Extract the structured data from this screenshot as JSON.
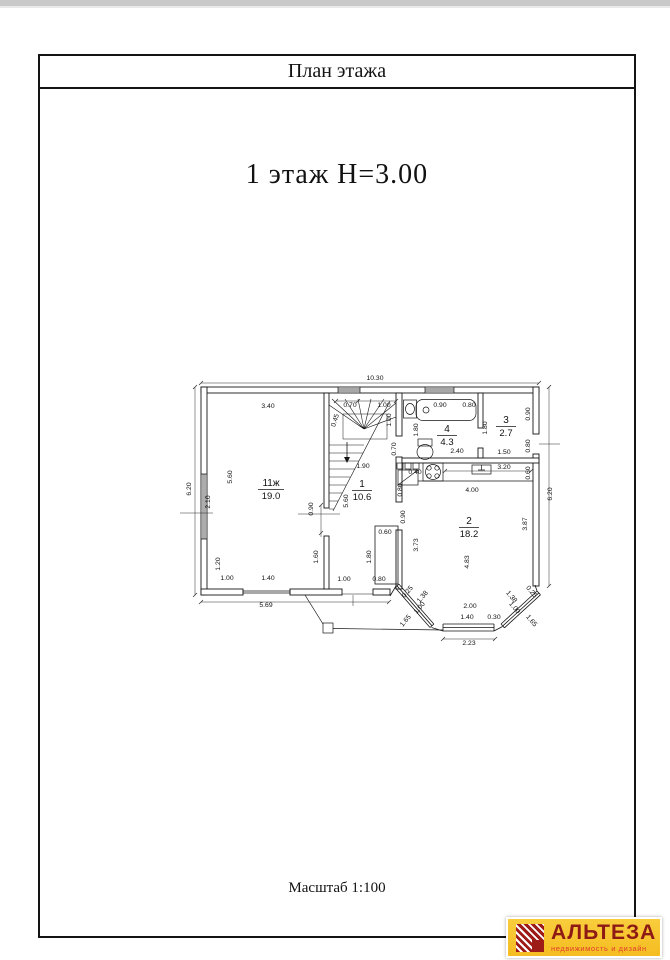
{
  "page": {
    "title": "План этажа",
    "heading": "1 этаж  Н=3.00",
    "scale_note": "Масштаб 1:100"
  },
  "logo": {
    "name": "АЛЬТЕЗА",
    "tagline": "недвижимость и дизайн",
    "bg_color": "#f6c230",
    "text_color": "#8e1a16",
    "tagline_color": "#e03c2d"
  },
  "plan": {
    "floor_height": "3.00",
    "rooms": [
      {
        "number": "11ж",
        "area": "19.0",
        "x": 231,
        "y": 430
      },
      {
        "number": "1",
        "area": "10.6",
        "x": 322,
        "y": 431
      },
      {
        "number": "2",
        "area": "18.2",
        "x": 429,
        "y": 468
      },
      {
        "number": "3",
        "area": "2.7",
        "x": 466,
        "y": 367
      },
      {
        "number": "4",
        "area": "4.3",
        "x": 407,
        "y": 376
      }
    ],
    "dimensions": [
      {
        "t": "10.30",
        "x": 335,
        "y": 324
      },
      {
        "t": "3.40",
        "x": 228,
        "y": 352
      },
      {
        "t": "0.70",
        "x": 310,
        "y": 351
      },
      {
        "t": "1.00",
        "x": 344,
        "y": 351
      },
      {
        "t": "0.45",
        "x": 297,
        "y": 365,
        "r": -72
      },
      {
        "t": "1.00",
        "x": 351,
        "y": 364,
        "r": -90
      },
      {
        "t": "0.90",
        "x": 400,
        "y": 351
      },
      {
        "t": "0.80",
        "x": 429,
        "y": 351
      },
      {
        "t": "1.80",
        "x": 378,
        "y": 374,
        "r": -90
      },
      {
        "t": "0.70",
        "x": 356,
        "y": 393,
        "r": -90
      },
      {
        "t": "2.40",
        "x": 417,
        "y": 397
      },
      {
        "t": "1.80",
        "x": 447,
        "y": 372,
        "r": -90
      },
      {
        "t": "0.90",
        "x": 490,
        "y": 358,
        "r": -90
      },
      {
        "t": "0.80",
        "x": 490,
        "y": 390,
        "r": -90
      },
      {
        "t": "1.50",
        "x": 464,
        "y": 398
      },
      {
        "t": "1.90",
        "x": 323,
        "y": 412
      },
      {
        "t": "5.60",
        "x": 308,
        "y": 445,
        "r": -90
      },
      {
        "t": "0.90",
        "x": 273,
        "y": 453,
        "r": -90
      },
      {
        "t": "1.60",
        "x": 278,
        "y": 501,
        "r": -90
      },
      {
        "t": "1.80",
        "x": 331,
        "y": 501,
        "r": -90
      },
      {
        "t": "0.60",
        "x": 345,
        "y": 478
      },
      {
        "t": "1.00",
        "x": 304,
        "y": 525
      },
      {
        "t": "0.80",
        "x": 339,
        "y": 525
      },
      {
        "t": "5.60",
        "x": 192,
        "y": 421,
        "r": -90
      },
      {
        "t": "2.10",
        "x": 170,
        "y": 446,
        "r": -90
      },
      {
        "t": "6.20",
        "x": 151,
        "y": 433,
        "r": -90
      },
      {
        "t": "1.20",
        "x": 180,
        "y": 508,
        "r": -90
      },
      {
        "t": "1.00",
        "x": 187,
        "y": 524
      },
      {
        "t": "1.40",
        "x": 228,
        "y": 524
      },
      {
        "t": "5.69",
        "x": 226,
        "y": 551
      },
      {
        "t": "0.40",
        "x": 375,
        "y": 418
      },
      {
        "t": "0.80",
        "x": 362,
        "y": 434,
        "r": -90
      },
      {
        "t": "0.90",
        "x": 365,
        "y": 461,
        "r": -90
      },
      {
        "t": "3.20",
        "x": 464,
        "y": 413
      },
      {
        "t": "0.60",
        "x": 490,
        "y": 417,
        "r": -90
      },
      {
        "t": "4.00",
        "x": 432,
        "y": 436
      },
      {
        "t": "3.73",
        "x": 378,
        "y": 489,
        "r": -90
      },
      {
        "t": "4.83",
        "x": 429,
        "y": 506,
        "r": -90
      },
      {
        "t": "3.87",
        "x": 487,
        "y": 468,
        "r": -90
      },
      {
        "t": "6.20",
        "x": 512,
        "y": 438,
        "r": -90
      },
      {
        "t": "0.25",
        "x": 369,
        "y": 537,
        "r": -50
      },
      {
        "t": "1.38",
        "x": 384,
        "y": 542,
        "r": -50
      },
      {
        "t": "1.00",
        "x": 381,
        "y": 553,
        "r": -50
      },
      {
        "t": "1.65",
        "x": 367,
        "y": 566,
        "r": -50
      },
      {
        "t": "2.00",
        "x": 430,
        "y": 552
      },
      {
        "t": "1.40",
        "x": 427,
        "y": 563
      },
      {
        "t": "0.30",
        "x": 454,
        "y": 563
      },
      {
        "t": "2.23",
        "x": 429,
        "y": 589
      },
      {
        "t": "1.38",
        "x": 470,
        "y": 542,
        "r": 50
      },
      {
        "t": "1.00",
        "x": 473,
        "y": 553,
        "r": 50
      },
      {
        "t": "0.25",
        "x": 490,
        "y": 537,
        "r": 50
      },
      {
        "t": "1.65",
        "x": 490,
        "y": 566,
        "r": 50
      }
    ]
  }
}
